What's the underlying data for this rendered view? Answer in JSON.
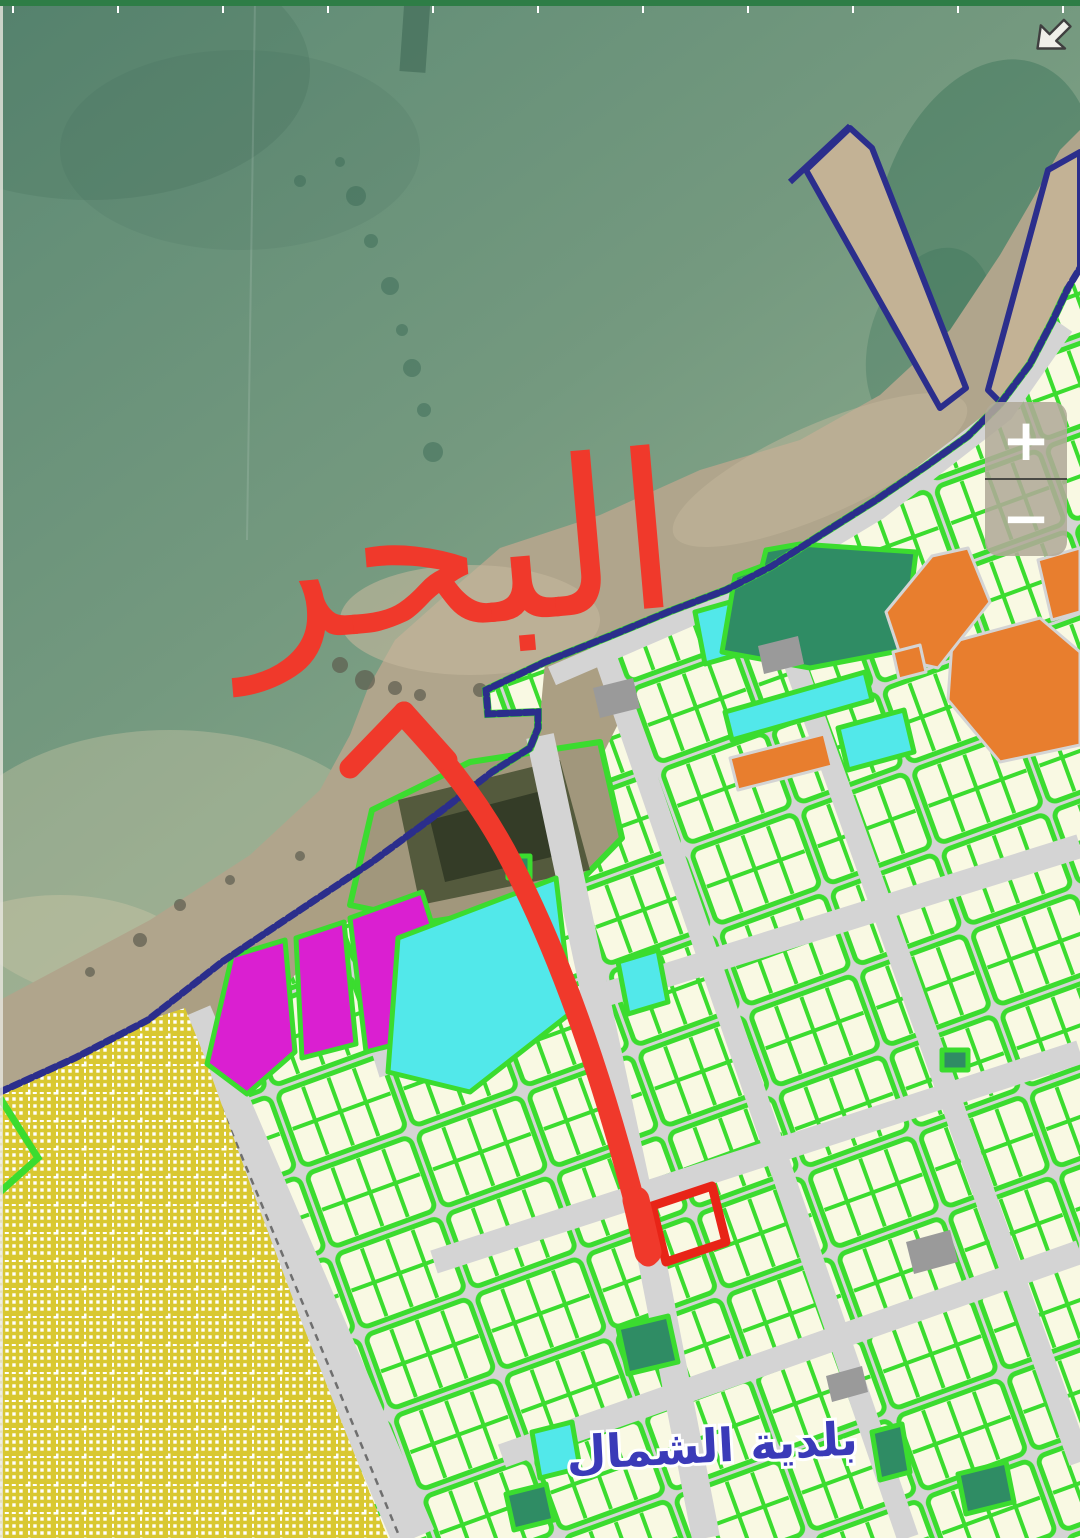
{
  "ui": {
    "top_bar": {
      "color": "#2e7d46"
    },
    "zoom_control": {
      "zoom_in_label": "+",
      "zoom_out_label": "−"
    },
    "icons": [
      {
        "name": "resize-arrow-icon",
        "glyph": "↙"
      }
    ]
  },
  "map": {
    "type": "satellite-parcel-plan",
    "sea_annotation": {
      "text": "البحر",
      "color": "#f0392b",
      "style": "hand-drawn red marker"
    },
    "municipality_label": {
      "text": "بلدية الشمال",
      "color": "#3a3ab8"
    },
    "arrow_annotation": {
      "color": "#f0392b",
      "points_from": "selected-plot",
      "points_to": "sea"
    },
    "selected_plot": {
      "outline_color": "#e82417"
    },
    "zone_colors": {
      "sea": "#74997f",
      "sand": "#b0a58c",
      "coast_outline": "#2b2e8c",
      "parcel_fill": "#f9f9e3",
      "parcel_border": "#3bdc2f",
      "road": "#d4d4d4",
      "reserved_yellow": "#d9c831",
      "special_magenta": "#da1fd1",
      "utility_cyan": "#52e8ea",
      "facility_dark_green": "#2f8c64",
      "commercial_orange": "#e87e2e",
      "gray_parcel": "#9a9a9a"
    }
  }
}
